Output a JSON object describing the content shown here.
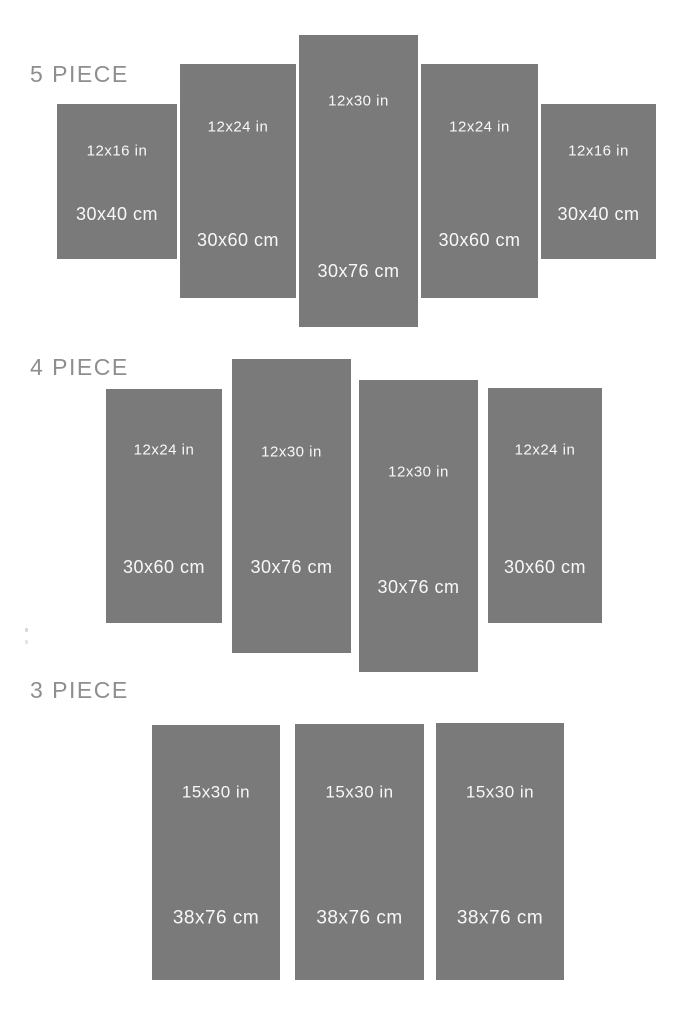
{
  "colors": {
    "panel": "#7a7a7a",
    "panel_text": "#f8f8f8",
    "section_label": "#8e8e8e",
    "background": "#ffffff"
  },
  "sections": [
    {
      "label": "5 PIECE",
      "panels": [
        {
          "inches": "12x16 in",
          "cm": "30x40 cm"
        },
        {
          "inches": "12x24 in",
          "cm": "30x60 cm"
        },
        {
          "inches": "12x30 in",
          "cm": "30x76 cm"
        },
        {
          "inches": "12x24 in",
          "cm": "30x60 cm"
        },
        {
          "inches": "12x16 in",
          "cm": "30x40 cm"
        }
      ]
    },
    {
      "label": "4 PIECE",
      "panels": [
        {
          "inches": "12x24 in",
          "cm": "30x60 cm"
        },
        {
          "inches": "12x30 in",
          "cm": "30x76 cm"
        },
        {
          "inches": "12x30 in",
          "cm": "30x76 cm"
        },
        {
          "inches": "12x24 in",
          "cm": "30x60 cm"
        }
      ]
    },
    {
      "label": "3 PIECE",
      "panels": [
        {
          "inches": "15x30 in",
          "cm": "38x76 cm"
        },
        {
          "inches": "15x30 in",
          "cm": "38x76 cm"
        },
        {
          "inches": "15x30 in",
          "cm": "38x76 cm"
        }
      ]
    }
  ]
}
